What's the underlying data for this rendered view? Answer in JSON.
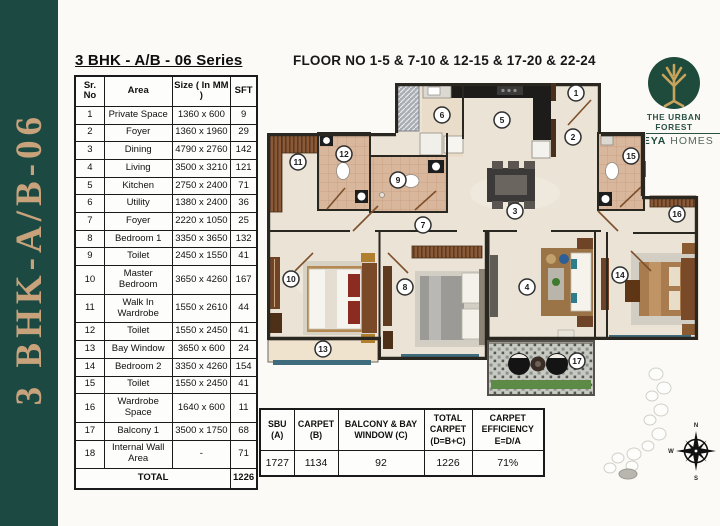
{
  "banner": {
    "text": "3 BHK-A/B-06"
  },
  "area_table": {
    "title": "3 BHK - A/B - 06 Series",
    "headers": [
      "Sr. No",
      "Area",
      "Size ( In MM )",
      "SFT"
    ],
    "rows": [
      [
        "1",
        "Private Space",
        "1360 x 600",
        "9"
      ],
      [
        "2",
        "Foyer",
        "1360 x 1960",
        "29"
      ],
      [
        "3",
        "Dining",
        "4790 x 2760",
        "142"
      ],
      [
        "4",
        "Living",
        "3500 x 3210",
        "121"
      ],
      [
        "5",
        "Kitchen",
        "2750 x 2400",
        "71"
      ],
      [
        "6",
        "Utility",
        "1380 x 2400",
        "36"
      ],
      [
        "7",
        "Foyer",
        "2220 x 1050",
        "25"
      ],
      [
        "8",
        "Bedroom 1",
        "3350 x 3650",
        "132"
      ],
      [
        "9",
        "Toilet",
        "2450 x 1550",
        "41"
      ],
      [
        "10",
        "Master Bedroom",
        "3650 x 4260",
        "167"
      ],
      [
        "11",
        "Walk In Wardrobe",
        "1550 x 2610",
        "44"
      ],
      [
        "12",
        "Toilet",
        "1550 x 2450",
        "41"
      ],
      [
        "13",
        "Bay Window",
        "3650 x 600",
        "24"
      ],
      [
        "14",
        "Bedroom 2",
        "3350 x 4260",
        "154"
      ],
      [
        "15",
        "Toilet",
        "1550 x 2450",
        "41"
      ],
      [
        "16",
        "Wardrobe Space",
        "1640 x 600",
        "11"
      ],
      [
        "17",
        "Balcony 1",
        "3500 x 1750",
        "68"
      ],
      [
        "18",
        "Internal Wall Area",
        "-",
        "71"
      ]
    ],
    "total_label": "TOTAL",
    "total_value": "1226"
  },
  "plan": {
    "title": "FLOOR NO 1-5 & 7-10 & 12-15 & 17-20 & 22-24",
    "markers": [
      "1",
      "2",
      "3",
      "4",
      "5",
      "6",
      "7",
      "8",
      "9",
      "10",
      "11",
      "12",
      "13",
      "14",
      "15",
      "16",
      "17"
    ]
  },
  "logo": {
    "name_line": "THE URBAN FOREST",
    "brand_bold": "KEYA",
    "brand_rest": " HOMES"
  },
  "summary_table": {
    "headers": [
      "SBU (A)",
      "CARPET (B)",
      "BALCONY & BAY WINDOW (C)",
      "TOTAL CARPET (D=B+C)",
      "CARPET EFFICIENCY E=D/A"
    ],
    "values": [
      "1727",
      "1134",
      "92",
      "1226",
      "71%"
    ]
  },
  "compass": {
    "n": "N",
    "e": "E",
    "s": "S",
    "w": "W"
  },
  "colors": {
    "banner_green": "#1c4a43",
    "banner_text_gold": "#c8a27b",
    "logo_green": "#1e4b3c",
    "logo_gold": "#c9a35c",
    "floor_cream": "#eae3d6",
    "toilet_tan": "#d9b79c",
    "wardrobe_brown": "#8a5a38",
    "window_teal": "#3f6c7c",
    "hedge_green": "#5d8a46",
    "wall_dark": "#2a2620"
  }
}
